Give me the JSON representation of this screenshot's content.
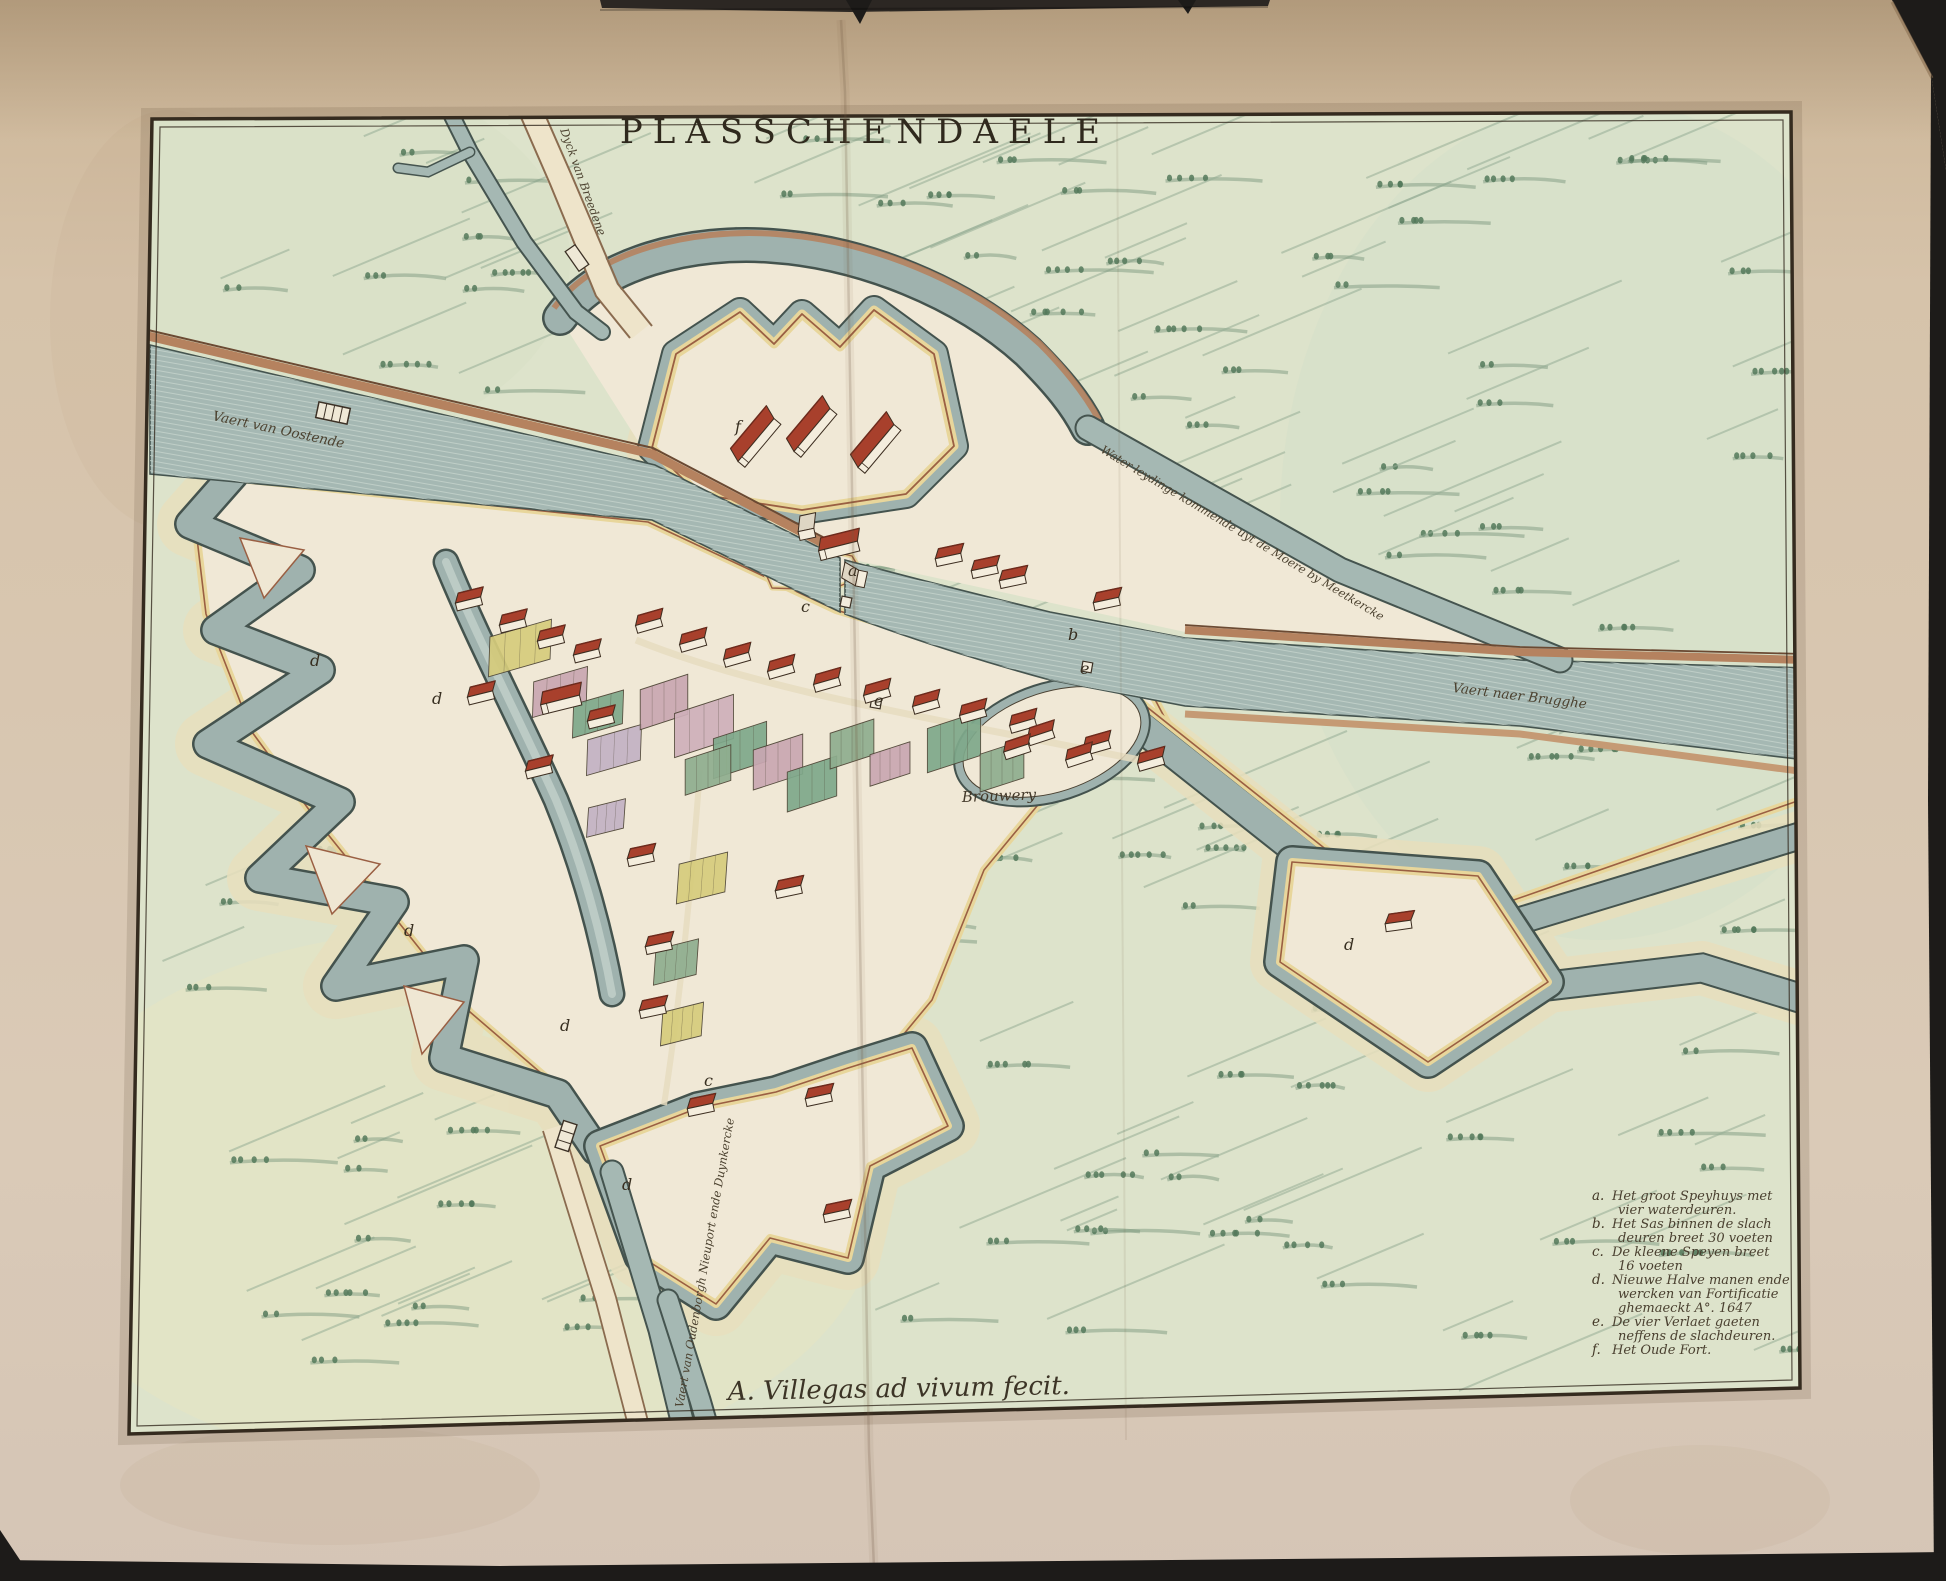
{
  "artwork": {
    "title": "PLASSCHENDAELE",
    "signature": "A. Villegas ad vivum fecit.",
    "labels": {
      "canal_oostende": "Vaert van Oostende",
      "dyck_breedene": "Dyck van Breedene",
      "water_leydinge": "Water leydinge kommende uyt de Moere by Meetkercke",
      "canal_brugghe": "Vaert naer Brugghe",
      "canal_oudenborgh": "Vaert van Oudenborgh Nieuport ende Duynkercke",
      "brouwery": "Brouwery"
    },
    "plate_letters": [
      "a",
      "b",
      "c",
      "d",
      "e",
      "f"
    ],
    "legend": {
      "items": [
        {
          "key": "a.",
          "lines": [
            "Het groot Speyhuys met",
            "vier waterdeuren."
          ]
        },
        {
          "key": "b.",
          "lines": [
            "Het Sas binnen de slach",
            "deuren breet 30 voeten"
          ]
        },
        {
          "key": "c.",
          "lines": [
            "De kleene Speyen breet",
            "16 voeten"
          ]
        },
        {
          "key": "d.",
          "lines": [
            "Nieuwe Halve manen ende",
            "wercken van Fortificatie",
            "ghemaeckt A°. 1647"
          ]
        },
        {
          "key": "e.",
          "lines": [
            "De vier Verlaet gaeten",
            "neffens de slachdeuren."
          ]
        },
        {
          "key": "f.",
          "lines": [
            "Het Oude Fort."
          ]
        }
      ]
    },
    "colors": {
      "backdrop": "#1d1b19",
      "paper": "#d6c3aa",
      "field_green": "#dde3cb",
      "water": "#a5b8b3",
      "moat": "#9fb2ae",
      "rampart_yellow": "#e8d69b",
      "rampart_maroon": "#9a5f43",
      "ground_cream": "#f0e8d6",
      "roof_red": "#a8402c",
      "road_brown": "#b5825f",
      "ink": "#3a3226"
    }
  }
}
